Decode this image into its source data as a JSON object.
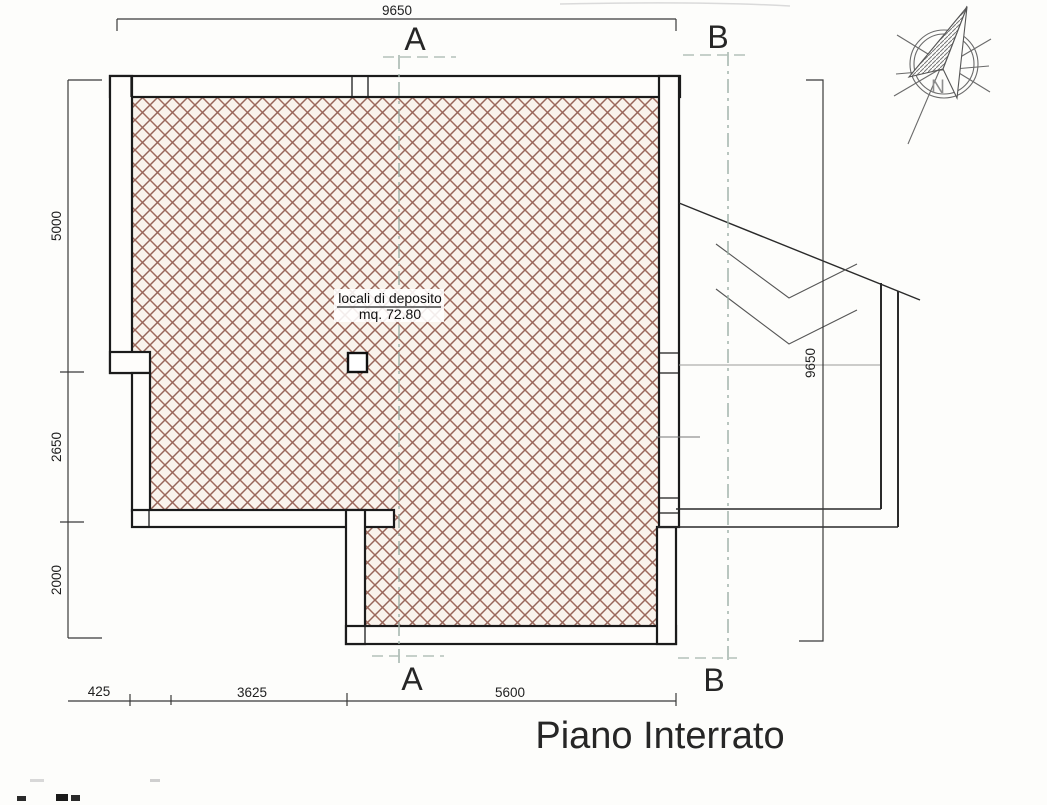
{
  "title": "Piano Interrato",
  "room_label": {
    "line1": "locali di deposito",
    "line2": "mq. 72.80"
  },
  "dims": {
    "top": "9650",
    "right": "9650",
    "left": [
      "5000",
      "2650",
      "2000"
    ],
    "bottom": [
      "425",
      "3625",
      "5600"
    ]
  },
  "sections": {
    "a": "A",
    "b": "B"
  },
  "compass": {
    "north_label": "N"
  },
  "colors": {
    "paper": "#fdfdfb",
    "hatch": "#a06a5c",
    "wall_ink": "#1b1b1b",
    "section_line": "#9cafa6",
    "dim_ink": "#3a3a3a"
  }
}
